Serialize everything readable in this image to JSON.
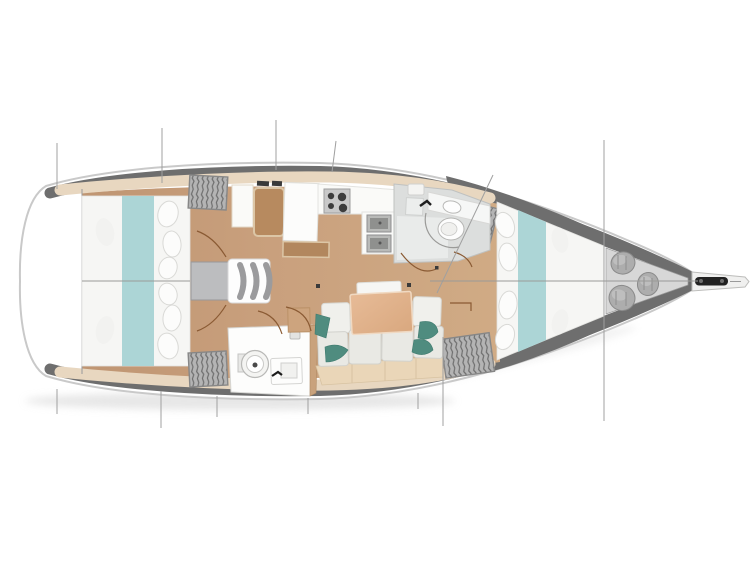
{
  "meta": {
    "type": "yacht-deck-plan",
    "view": "top-down",
    "orientation": "bow-right",
    "visible_text": ""
  },
  "canvas": {
    "width": 751,
    "height": 563,
    "background": "#ffffff"
  },
  "colors": {
    "hull_outline": "#c9c9c9",
    "deck_band": "#6e6e6e",
    "side_deck": "#ffffff",
    "floor_wood": "#c69d7b",
    "floor_wood_light": "#cfa884",
    "shelf_trim": "#e8d7c0",
    "mattress": "#f6f6f4",
    "bed_runner_teal": "#acd5d6",
    "cushion": "#e9e9e4",
    "cushion_back": "#f0f0ec",
    "pillow_teal": "#4f8c7f",
    "settee_base": "#ead6b8",
    "table_wood": "#e2b38d",
    "seat_brown": "#b78a5f",
    "trim_beige": "#dcc6a6",
    "fixture_white": "#fdfdfc",
    "fixture_outline": "#b9b9b7",
    "head_floor": "#dcdedd",
    "locker_gray": "#b4b4b4",
    "engine_gray": "#bcbdbf",
    "sail_locker_bg": "#d7d7d7",
    "sail_bag": "#adadad",
    "stove_panel": "#c9c9c9",
    "burner_dark": "#3d3d3d",
    "door_arc": "#8a5a33",
    "rigging_line": "#a0a0a0",
    "anchor_black": "#222222"
  },
  "icons": {
    "toilet": "concentric-circles",
    "sink": "rect-basin",
    "stove": "burner-circles",
    "hanging_locker": "striped-rect",
    "companionway": "curved-steps",
    "sail_bags": "gray-cylinders",
    "anchor_roller": "black-rounded-bar"
  }
}
